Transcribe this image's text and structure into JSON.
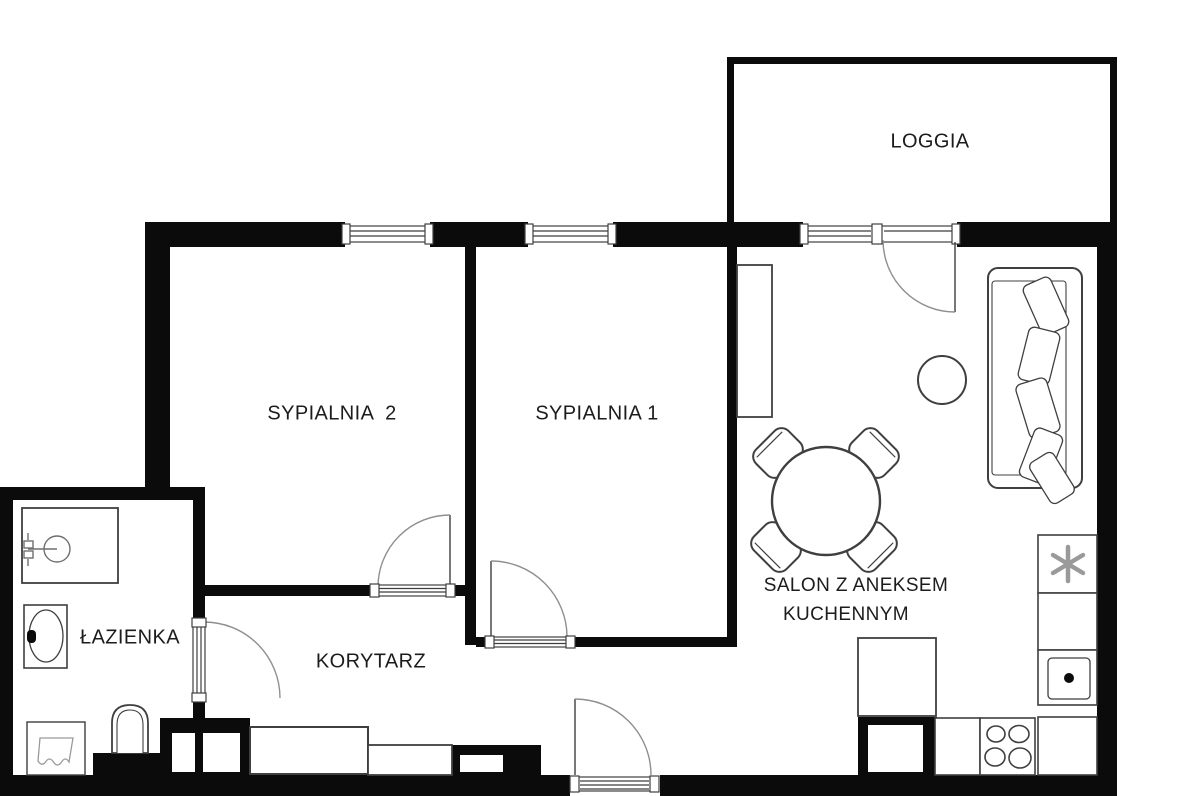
{
  "plan_title": "apartment-floorplan",
  "rooms": {
    "loggia": {
      "label": "LOGGIA"
    },
    "sypialnia2": {
      "label": "SYPIALNIA  2"
    },
    "sypialnia1": {
      "label": "SYPIALNIA 1"
    },
    "lazienka": {
      "label": "ŁAZIENKA"
    },
    "korytarz": {
      "label": "KORYTARZ"
    },
    "salon": {
      "label_line1": "SALON Z ANEKSEM",
      "label_line2": "KUCHENNYM"
    }
  },
  "icons": {
    "fridge": "snowflake-icon",
    "stove": "four-burners-icon",
    "kitchen_sink": "sink-basin-dot-icon",
    "bath_sink": "oval-basin-icon",
    "shower": "shower-head-icon",
    "washer": "laundry-icon",
    "toilet": "toilet-icon"
  },
  "colors": {
    "wall": "#0b0b0b",
    "line": "#3f3f3f",
    "soft_line": "#8f8f8f",
    "background": "#ffffff",
    "text": "#1c1c1c"
  }
}
